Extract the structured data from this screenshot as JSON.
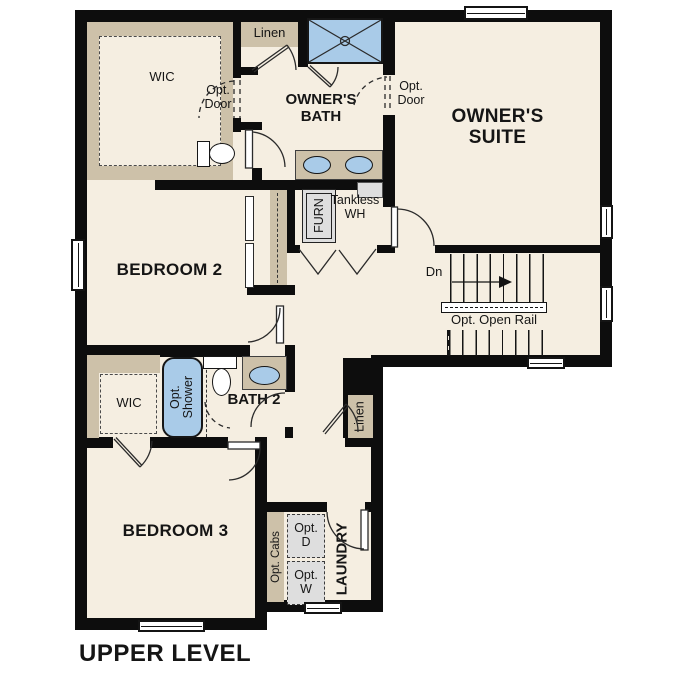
{
  "plan_title": "UPPER LEVEL",
  "colors": {
    "floor": "#f5eee1",
    "wall": "#0d0d0d",
    "tan": "#cdc1a9",
    "blue": "#a9cbe8",
    "gray": "#dedede"
  },
  "rooms": {
    "owners_suite": "OWNER'S SUITE",
    "owners_bath": "OWNER'S BATH",
    "bedroom2": "BEDROOM 2",
    "bedroom3": "BEDROOM 3",
    "bath2": "BATH 2",
    "laundry": "LAUNDRY",
    "wic_owners": "WIC",
    "wic_bath2": "WIC",
    "linen_hall": "Linen",
    "linen_lower": "Linen"
  },
  "annotations": {
    "opt_door_wic": "Opt. Door",
    "opt_door_suite": "Opt. Door",
    "furnace": "FURN",
    "tankless_wh": "Tankless WH",
    "stairs_down": "Dn",
    "opt_open_rail": "Opt. Open Rail",
    "opt_shower": "Opt. Shower",
    "opt_cabs": "Opt. Cabs",
    "opt_dryer": "Opt. D",
    "opt_washer": "Opt. W"
  }
}
